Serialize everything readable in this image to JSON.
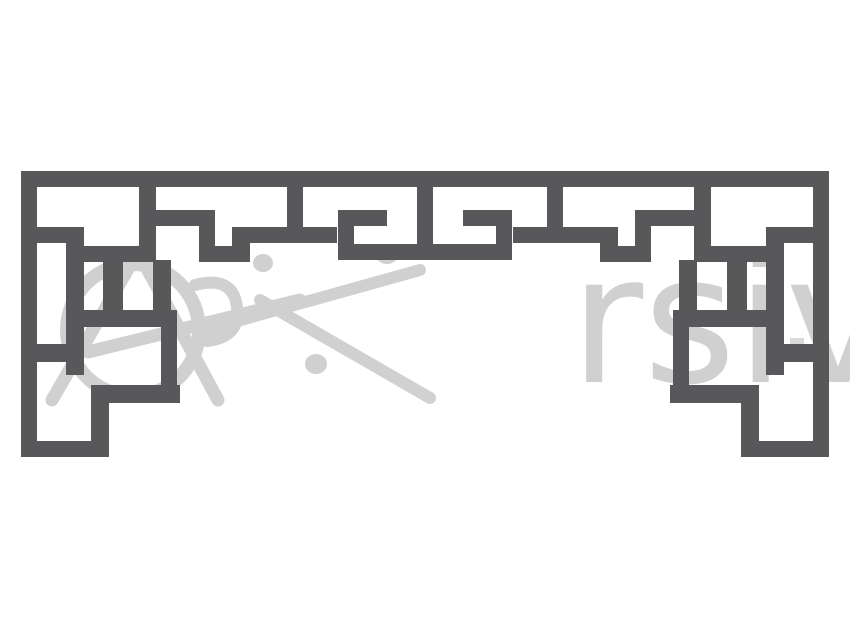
{
  "image": {
    "description": "Symmetric Chinese lattice fretwork border ornament, dark gray geometric meander bars on white background",
    "width": 850,
    "height": 630
  },
  "colors": {
    "background": "#ffffff",
    "pattern": "#58585a",
    "watermark": "#b4b4b6"
  },
  "watermark": {
    "visible_letters": "rsiv",
    "has_circle_logo": true
  },
  "pattern": {
    "mirror_axis_x": 425,
    "bars_left_half": [
      {
        "name": "top-band",
        "x": 21,
        "y": 171,
        "w": 808,
        "h": 16
      },
      {
        "name": "outer-left",
        "x": 21,
        "y": 171,
        "w": 16,
        "h": 286
      },
      {
        "name": "leg-bottom",
        "x": 21,
        "y": 441,
        "w": 88,
        "h": 16
      },
      {
        "name": "under-w1",
        "x": 37,
        "y": 227,
        "w": 45,
        "h": 16
      },
      {
        "name": "col1",
        "x": 66,
        "y": 227,
        "w": 18,
        "h": 148
      },
      {
        "name": "a1",
        "x": 66,
        "y": 246,
        "w": 89,
        "h": 16
      },
      {
        "name": "p-divider",
        "x": 103,
        "y": 262,
        "w": 20,
        "h": 48
      },
      {
        "name": "s-riser",
        "x": 153,
        "y": 260,
        "w": 18,
        "h": 50
      },
      {
        "name": "q-bar",
        "x": 66,
        "y": 310,
        "w": 111,
        "h": 17
      },
      {
        "name": "v-stub",
        "x": 37,
        "y": 344,
        "w": 29,
        "h": 18
      },
      {
        "name": "t-riser",
        "x": 161,
        "y": 327,
        "w": 16,
        "h": 76
      },
      {
        "name": "r-bar",
        "x": 93,
        "y": 385,
        "w": 87,
        "h": 18
      },
      {
        "name": "w-riser",
        "x": 91,
        "y": 385,
        "w": 18,
        "h": 72
      },
      {
        "name": "g-stem",
        "x": 139,
        "y": 171,
        "w": 17,
        "h": 91
      },
      {
        "name": "f-arm",
        "x": 139,
        "y": 210,
        "w": 76,
        "h": 16
      },
      {
        "name": "e-tip",
        "x": 199,
        "y": 210,
        "w": 16,
        "h": 52
      },
      {
        "name": "d-bar",
        "x": 199,
        "y": 246,
        "w": 51,
        "h": 16
      },
      {
        "name": "c-riser",
        "x": 232,
        "y": 227,
        "w": 18,
        "h": 35
      },
      {
        "name": "b-bar",
        "x": 232,
        "y": 227,
        "w": 105,
        "h": 16
      },
      {
        "name": "a-stem",
        "x": 287,
        "y": 171,
        "w": 16,
        "h": 72
      },
      {
        "name": "hook-stem",
        "x": 338,
        "y": 210,
        "w": 16,
        "h": 50
      },
      {
        "name": "hook-arm",
        "x": 338,
        "y": 210,
        "w": 49,
        "h": 16
      },
      {
        "name": "center-bottom",
        "x": 338,
        "y": 244,
        "w": 174,
        "h": 16
      },
      {
        "name": "center-stem",
        "x": 417,
        "y": 171,
        "w": 16,
        "h": 89
      }
    ]
  }
}
